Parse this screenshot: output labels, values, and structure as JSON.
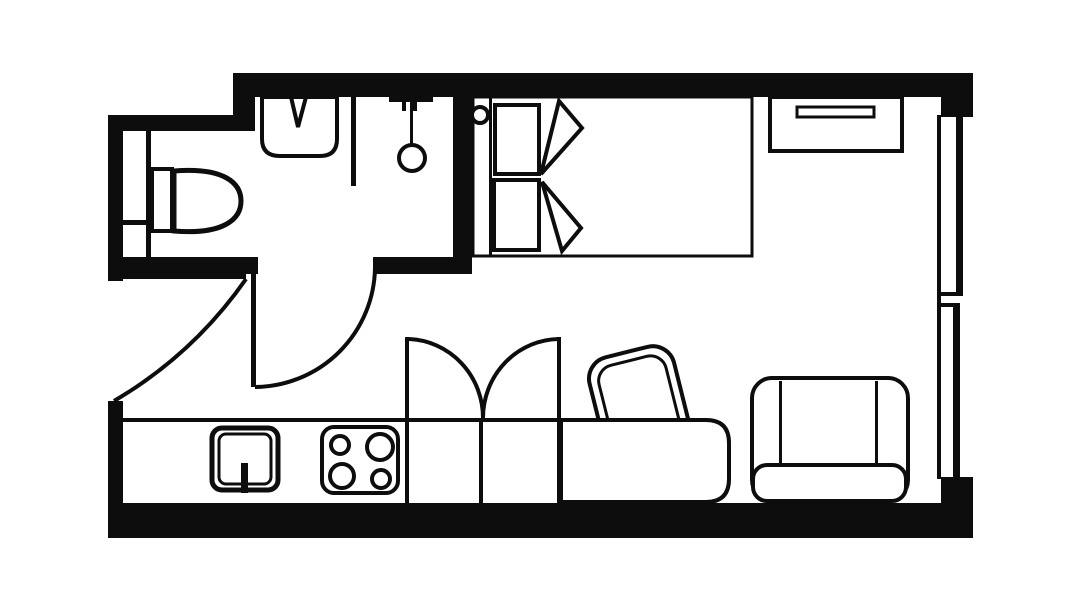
{
  "plan": {
    "background_color": "#ffffff",
    "line_color": "#0d0d0d",
    "drawing_style": "black line-art architectural floor plan, no text labels",
    "rooms": [
      {
        "name": "bathroom",
        "position": "top-left",
        "fixtures": [
          "toilet",
          "washbasin-with-tap",
          "shower-head",
          "service-duct-strip",
          "partition-wall"
        ]
      },
      {
        "name": "main-room",
        "position": "right",
        "fixtures": [
          "single-bed",
          "headboard",
          "pillow-top",
          "pillow-bottom",
          "folded-blanket",
          "wall-light",
          "shelf-unit-with-drawer",
          "window",
          "desk",
          "desk-chair",
          "armchair"
        ]
      },
      {
        "name": "kitchenette",
        "position": "bottom-left",
        "fixtures": [
          "counter-run",
          "kitchen-sink-with-tap",
          "cooktop"
        ]
      }
    ],
    "doors": [
      {
        "name": "entry-door",
        "location": "left-wall",
        "symbol": "leaf-with-quarter-arc"
      },
      {
        "name": "bathroom-door",
        "location": "bathroom-bottom-wall",
        "symbol": "leaf-with-quarter-arc"
      },
      {
        "name": "wardrobe-double-doors",
        "location": "bottom-center",
        "symbol": "two-leaves-with-arcs"
      }
    ],
    "counts": {
      "cooktop_burners": 4,
      "pillows": 2,
      "wardrobe_sections": 2,
      "window_panels": 2
    }
  }
}
